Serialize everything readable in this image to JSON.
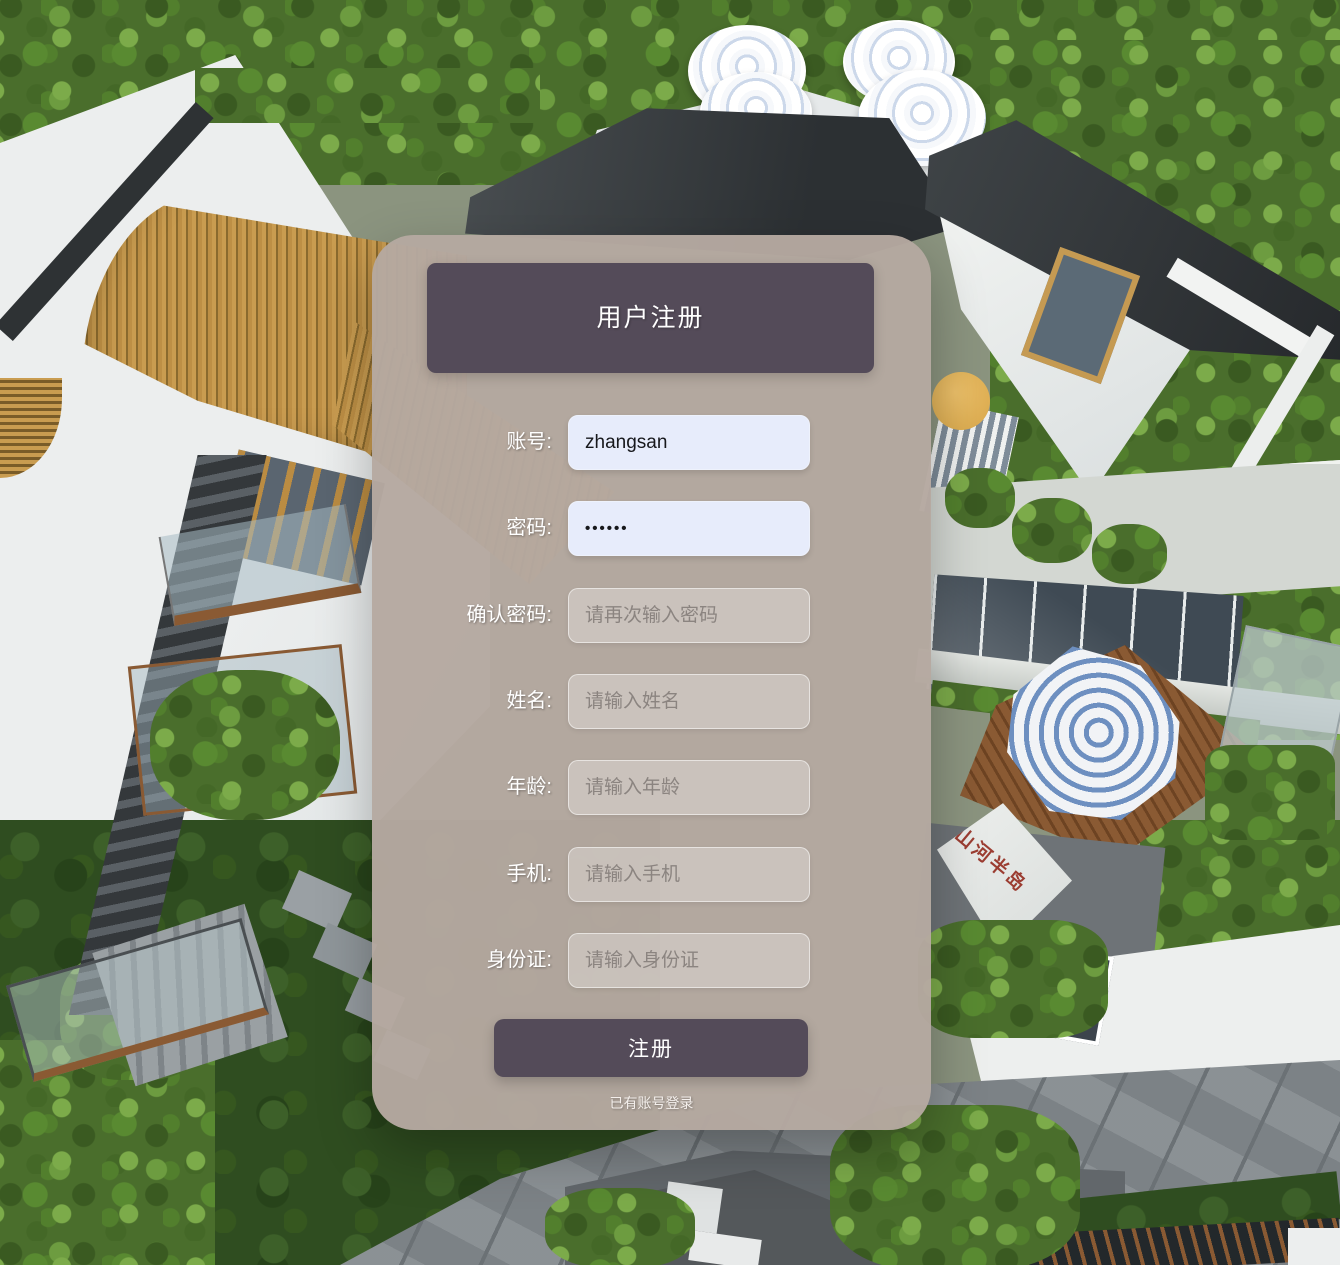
{
  "form": {
    "title": "用户注册",
    "fields": [
      {
        "label": "账号:",
        "value": "zhangsan",
        "placeholder": ""
      },
      {
        "label": "密码:",
        "value": "••••••",
        "placeholder": ""
      },
      {
        "label": "确认密码:",
        "value": "",
        "placeholder": "请再次输入密码"
      },
      {
        "label": "姓名:",
        "value": "",
        "placeholder": "请输入姓名"
      },
      {
        "label": "年龄:",
        "value": "",
        "placeholder": "请输入年龄"
      },
      {
        "label": "手机:",
        "value": "",
        "placeholder": "请输入手机"
      },
      {
        "label": "身份证:",
        "value": "",
        "placeholder": "请输入身份证"
      }
    ],
    "submit_label": "注册",
    "login_link_label": "已有账号登录"
  },
  "background": {
    "calligraphy": "山河半岛",
    "description": "aerial 3d render of modern white villas with gardens"
  },
  "colors": {
    "accent_dark": "#544b59",
    "panel_tan": "#b5a8a0",
    "input_filled": "#e7ecfb",
    "umbrella_blue": "#6d8fc0"
  }
}
